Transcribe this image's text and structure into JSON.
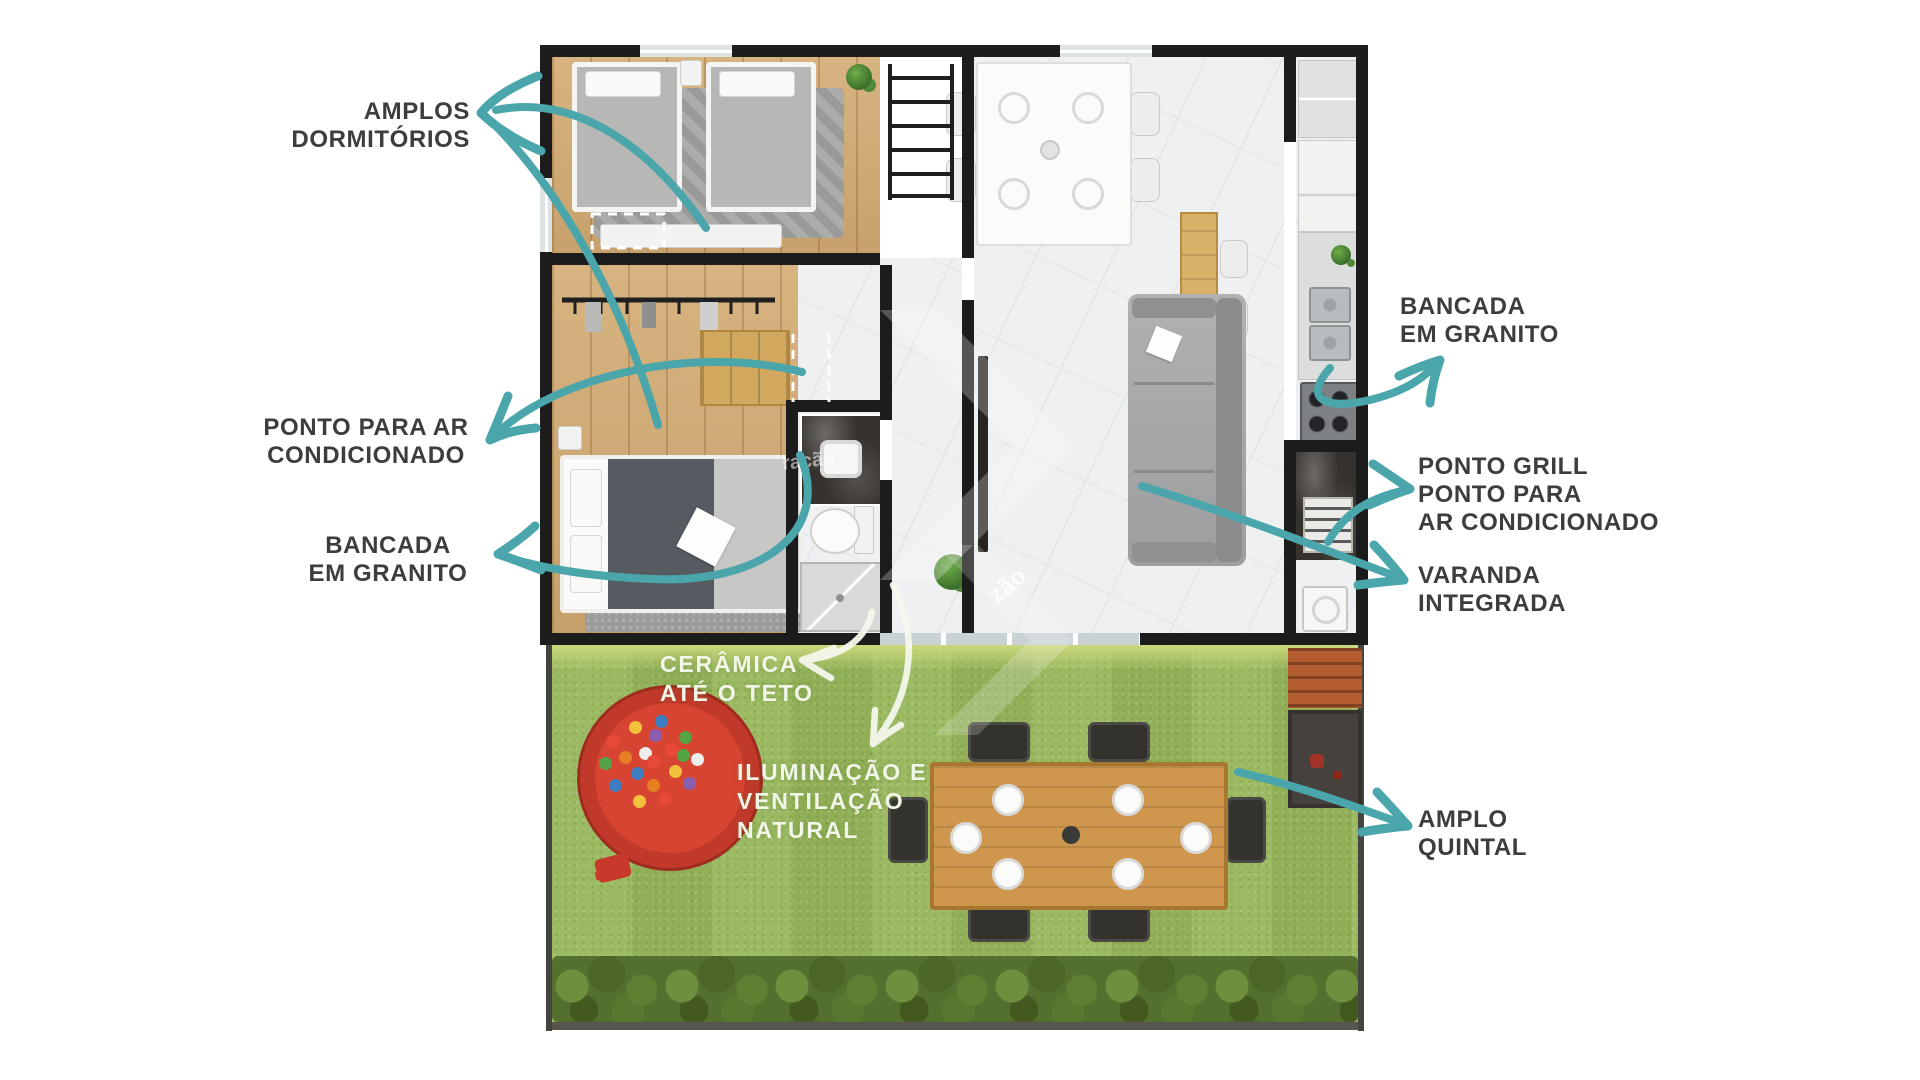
{
  "annotations": {
    "amplos_dormitorios": {
      "line1": "AMPLOS",
      "line2": "DORMITÓRIOS"
    },
    "ponto_ar": {
      "line1": "PONTO PARA AR",
      "line2": "CONDICIONADO"
    },
    "bancada_esquerda": {
      "line1": "BANCADA",
      "line2": "EM GRANITO"
    },
    "bancada_direita": {
      "line1": "BANCADA",
      "line2": "EM GRANITO"
    },
    "ponto_grill": {
      "line1": "PONTO GRILL",
      "line2": "PONTO PARA",
      "line3": "AR CONDICIONADO"
    },
    "varanda_integrada": {
      "line1": "VARANDA",
      "line2": "INTEGRADA"
    },
    "amplo_quintal": {
      "line1": "AMPLO",
      "line2": "QUINTAL"
    },
    "ceramica": {
      "line1": "CERÂMICA",
      "line2": "ATÉ O TETO"
    },
    "iluminacao": {
      "line1": "ILUMINAÇÃO E",
      "line2": "VENTILAÇÃO",
      "line3": "NATURAL"
    }
  },
  "watermark": {
    "fragment_center": "ração",
    "fragment_bottom": "zão"
  },
  "colors": {
    "accent_teal": "#4aa6aa",
    "label_dark": "#3d3d3d",
    "white_label": "#f2f6e9",
    "grass": "#96b65a",
    "wood_floor": "#d3ab72",
    "granite": "#35312d"
  }
}
